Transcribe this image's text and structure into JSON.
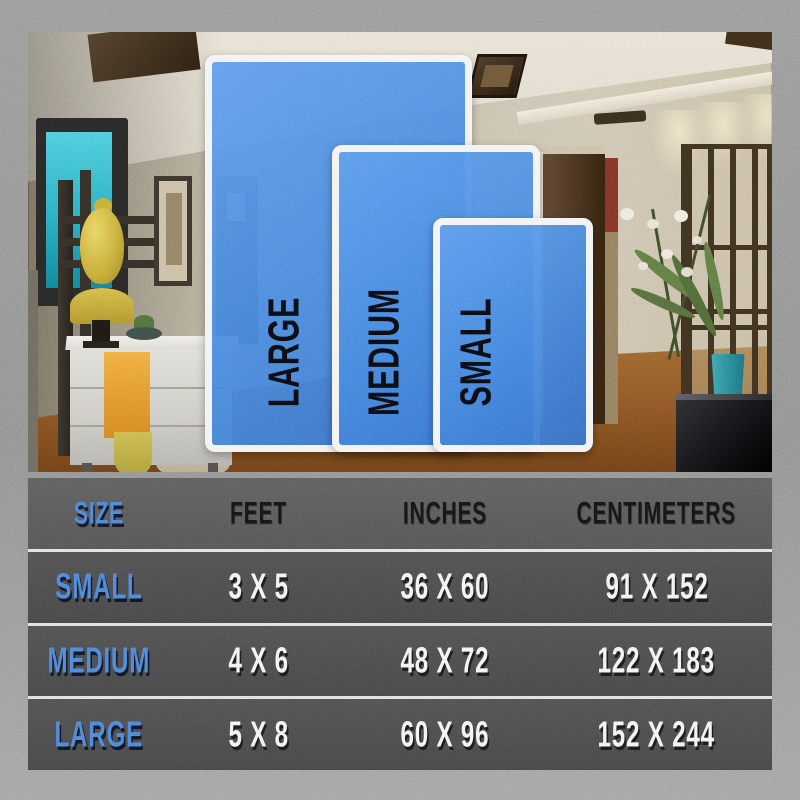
{
  "overlay_labels": {
    "large": "LARGE",
    "medium": "MEDIUM",
    "small": "SMALL"
  },
  "table": {
    "headers": {
      "size": "SIZE",
      "feet": "FEET",
      "inches": "INCHES",
      "centimeters": "CENTIMETERS"
    },
    "rows": [
      {
        "size": "SMALL",
        "feet": "3 X 5",
        "inches": "36 X 60",
        "centimeters": "91 X 152"
      },
      {
        "size": "MEDIUM",
        "feet": "4 X 6",
        "inches": "48 X 72",
        "centimeters": "122 X 183"
      },
      {
        "size": "LARGE",
        "feet": "5 X 8",
        "inches": "60 X 96",
        "centimeters": "152 X 244"
      }
    ]
  },
  "colors": {
    "accent_blue": "#4a80d4",
    "rug_overlay_blue": "#427fdc",
    "rug_border_white": "#f2f2f2",
    "table_row_gray": "#474747",
    "table_header_gray": "#565656",
    "frame_gray": "#919191",
    "value_text_white": "#f4f2ee",
    "header_text_black": "#151515",
    "tv_screen_teal": "#2fb6c9",
    "buddha_gold": "#d3b945",
    "cloth_orange": "#e8972f",
    "floor_brown": "#8a5526"
  }
}
